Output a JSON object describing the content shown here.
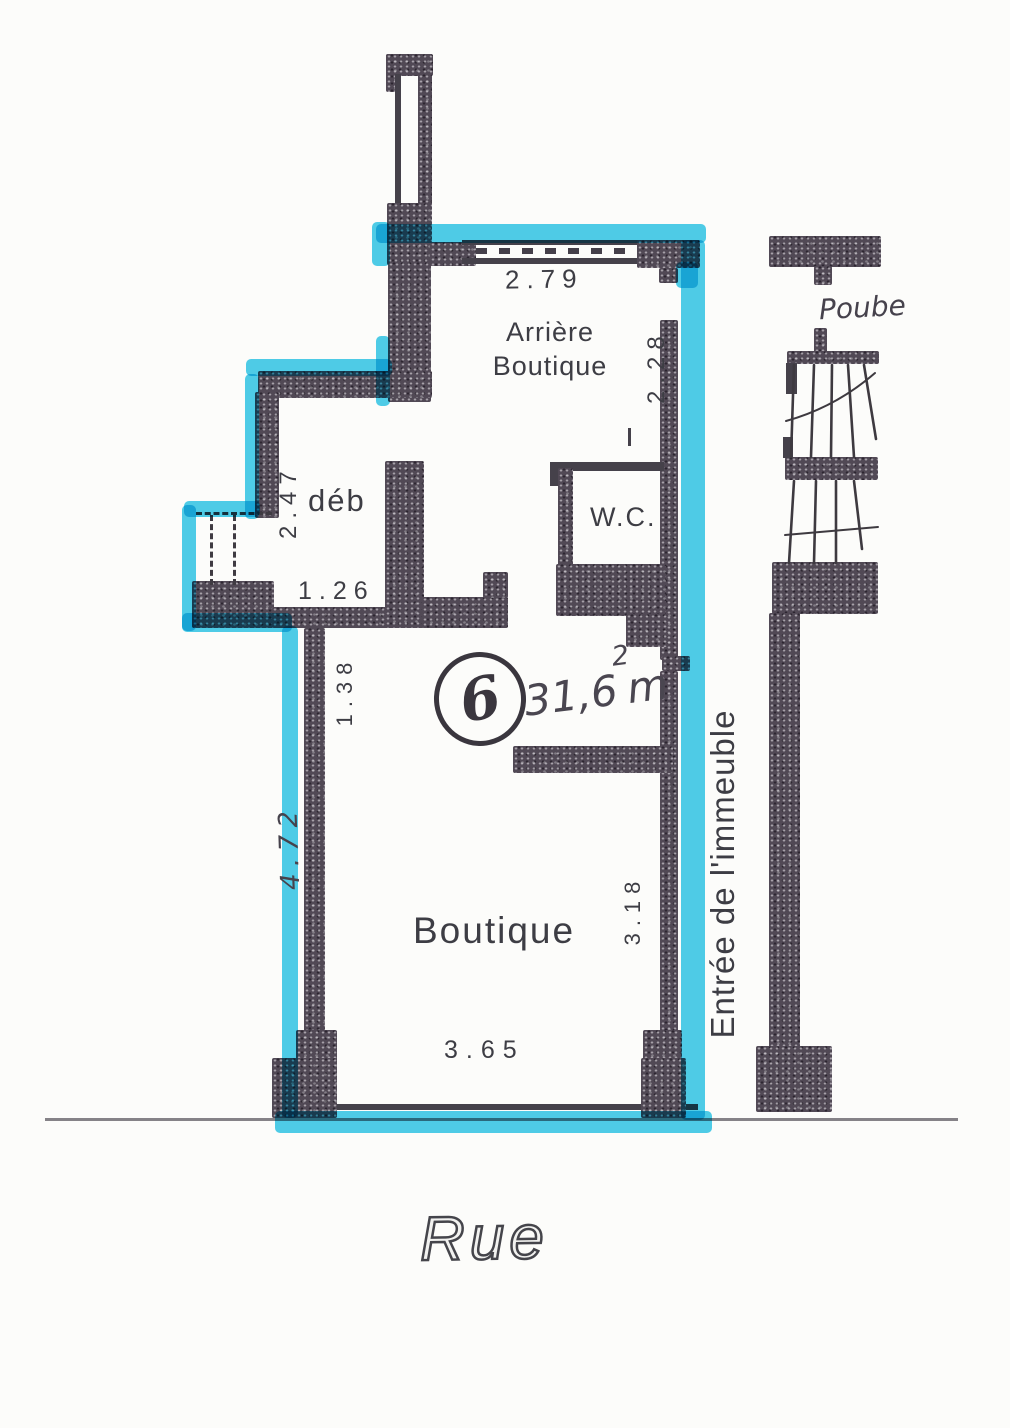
{
  "colors": {
    "highlight": "#3cc9e9",
    "wall_ink": "#4a424b",
    "line_ink": "#3e3a40"
  },
  "rooms": {
    "arriere_boutique": {
      "line1": "Arrière",
      "line2": "Boutique"
    },
    "deb": {
      "label": "déb"
    },
    "wc": {
      "label": "W.C."
    },
    "boutique": {
      "label": "Boutique"
    }
  },
  "dimensions": {
    "arriere_width": "2.79",
    "arriere_depth": "2.28",
    "deb_depth": "2.47",
    "deb_opening": "1.26",
    "upper_left_width": "1.38",
    "left_side": "4.72",
    "right_side": "3.18",
    "shopfront_width": "3.65"
  },
  "annotations": {
    "unit_number": "6",
    "area_value": "31,6",
    "area_unit": "m",
    "area_exponent": "2",
    "building_entrance": "Entrée de l'immeuble",
    "bins": "Poube",
    "street": "Rue"
  }
}
